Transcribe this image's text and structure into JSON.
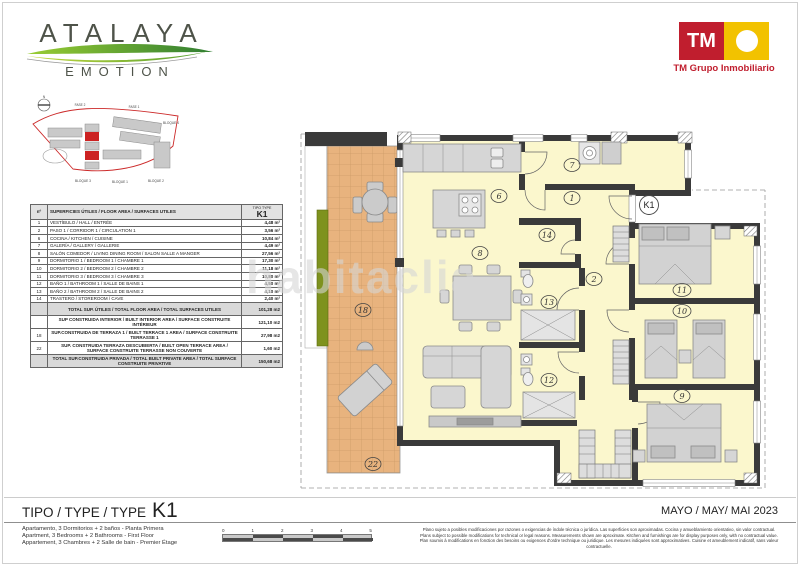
{
  "header": {
    "brand": {
      "name": "ATALAYA",
      "subname": "EMOTION"
    },
    "developer": {
      "initials": "TM",
      "company": "TM Grupo Inmobiliario"
    }
  },
  "siteplan": {
    "north_label": "N",
    "labels": {
      "fase2": "FASE 2",
      "fase1": "FASE 1",
      "bloque1": "BLOQUE 1",
      "bloque2": "BLOQUE 2",
      "bloque3": "BLOQUE 3",
      "bloque4": "BLOQUE 4"
    }
  },
  "table": {
    "header": {
      "num": "nº",
      "label": "SUPERFICIES ÚTILES / FLOOR AREA / SURFACES UTILES",
      "type_caption": "TIPO TYPE",
      "type_value": "K1"
    },
    "rows": [
      {
        "n": "1",
        "label": "VESTÍBULO / HALL / ENTRÉE",
        "value": "4,48 m²"
      },
      {
        "n": "2",
        "label": "PASO 1 / CORRIDOR 1 / CIRCULATION 1",
        "value": "3,56 m²"
      },
      {
        "n": "6",
        "label": "COCINA / KITCHEN / CUISINE",
        "value": "10,84 m²"
      },
      {
        "n": "7",
        "label": "GALERÍA / GALLERY / GALLERIE",
        "value": "4,49 m²"
      },
      {
        "n": "8",
        "label": "SALÓN COMEDOR / LIVING DINING ROOM / SALON SALLE A MANGER",
        "value": "27,56 m²"
      },
      {
        "n": "9",
        "label": "DORMITORIO 1 / BEDROOM 1 / CHAMBRE 1",
        "value": "17,30 m²"
      },
      {
        "n": "10",
        "label": "DORMITORIO 2 / BEDROOM 2 / CHAMBRE 2",
        "value": "11,18 m²"
      },
      {
        "n": "11",
        "label": "DORMITORIO 3 / BEDROOM 3 / CHAMBRE 3",
        "value": "10,80 m²"
      },
      {
        "n": "12",
        "label": "BAÑO 1 / BATHROOM 1 / SALLE DE BAINS 1",
        "value": "4,50 m²"
      },
      {
        "n": "13",
        "label": "BAÑO 2 / BATHROOM 2 / SALLE DE BAINS 2",
        "value": "4,10 m²"
      },
      {
        "n": "14",
        "label": "TRASTERO / STOREROOM / CAVE",
        "value": "2,40 m²"
      }
    ],
    "summary": [
      {
        "n": "",
        "label": "TOTAL SUP. ÚTILES / TOTAL FLOOR AREA / TOTAL SURFACES UTILES",
        "value": "101,28 m2",
        "shaded": true
      },
      {
        "n": "",
        "label": "SUP CONSTRUIDA INTERIOR / BUILT INTERIOR AREA / SURFACE CONSTRUITE INTÉRIEUR",
        "value": "121,10 m2",
        "shaded": false
      },
      {
        "n": "18",
        "label": "SUP.CONSTRUIDA DE TERRAZA 1 / BUILT TERRACE 1 AREA / SURFACE CONSTRUITE TERRASSE 1",
        "value": "27,98 m2",
        "shaded": false
      },
      {
        "n": "22",
        "label": "SUP. CONSTRUIDA TERRAZA DESCUBIERTA / BUILT OPEN TERRACE AREA / SURFACE CONSTRUITE TERRASSE NON COUVERTE",
        "value": "1,60 m2",
        "shaded": false
      },
      {
        "n": "",
        "label": "TOTAL SUP.CONSTRUIDA PRIVADA / TOTAL BUILT PRIVATE AREA / TOTAL SURFACE CONSTRUITE PRIVATIVE",
        "value": "150,68 m2",
        "shaded": true
      }
    ]
  },
  "plan": {
    "unit_label": "K1",
    "watermark": "habitaclia",
    "rooms": {
      "r1": "1",
      "r2": "2",
      "r6": "6",
      "r7": "7",
      "r8": "8",
      "r9": "9",
      "r10": "10",
      "r11": "11",
      "r12": "12",
      "r13": "13",
      "r14": "14",
      "r18": "18",
      "r22": "22"
    }
  },
  "footer": {
    "title_prefix": "TIPO / TYPE / TYPE",
    "unit": "K1",
    "descriptions": [
      "Apartamento, 3 Dormitorios + 2 baños - Planta Primera",
      "Apartment, 3 Bedrooms + 2 Bathrooms - First Floor",
      "Appartement, 3 Chambres + 2 Salle de bain - Premier Étage"
    ],
    "date": "MAYO / MAY/ MAI 2023",
    "scale_ticks": [
      "0",
      "1",
      "2",
      "3",
      "4",
      "5"
    ],
    "disclaimer": [
      "Plano sujeto a posibles modificaciones por razones o exigencias de índole técnica o jurídica. Las superficies son aproximadas. Cocina y amueblamiento orientativo, sin valor contractual.",
      "Plans subject to possible modifications for technical or legal reasons. Measurements shown are aproximate. Kitchen and furnishings are for display purposes only, with no contractual value.",
      "Plan soumis à modifications en fonction des besoins ou exigences d'ordre technique ou juridique. Les mesures indiquées sont approximatives. Cuisine et ameublement indicatif, sans valeur contractuelle."
    ]
  },
  "colors": {
    "wall": "#3A3A3A",
    "room_fill": "#FBF7CD",
    "terrace_tile": "#E8B37E",
    "planter_green": "#7E921E",
    "tm_red": "#C01E2E",
    "tm_yellow": "#F2C200",
    "site_boundary_red": "#CC2A2A"
  }
}
